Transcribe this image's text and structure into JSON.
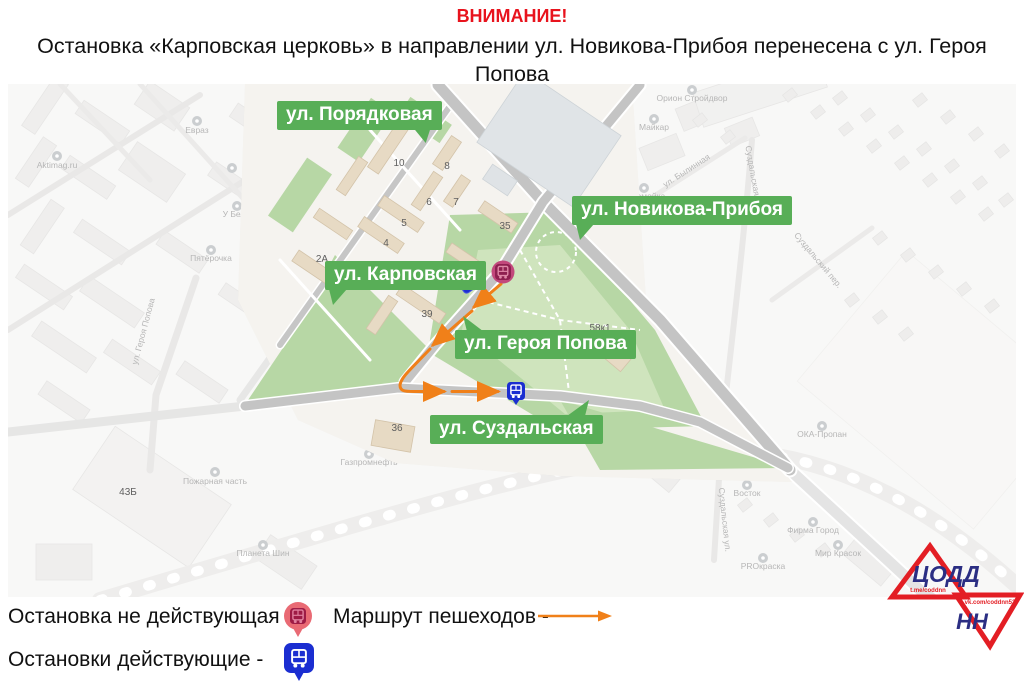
{
  "header": {
    "attention": "ВНИМАНИЕ!",
    "line1": "Остановка «Карповская церковь» в направлении ул. Новикова-Прибоя перенесена с ул. Героя Попова",
    "line2": "на ул. Суздальскую в связи с изменением движения маршрутов общественного транспорта."
  },
  "map": {
    "street_badges": [
      {
        "label": "ул. Порядковая"
      },
      {
        "label": "ул. Новикова-Прибоя"
      },
      {
        "label": "ул. Карповская"
      },
      {
        "label": "ул. Героя Попова"
      },
      {
        "label": "ул. Суздальская"
      }
    ],
    "building_numbers": [
      "10",
      "8",
      "6",
      "7",
      "5",
      "4",
      "2А",
      "35",
      "37",
      "39",
      "36",
      "58к1",
      "43Б"
    ],
    "minor_labels": [
      {
        "text": "Карповская ул."
      },
      {
        "text": "Aktimag.ru"
      },
      {
        "text": "Евраз"
      },
      {
        "text": "У Белы"
      },
      {
        "text": "Пятёрочка"
      },
      {
        "text": "ул. Героя Попова"
      },
      {
        "text": "Пожарная часть"
      },
      {
        "text": "Газпромнефть"
      },
      {
        "text": "Планета Шин"
      },
      {
        "text": "Орион Стройдвор"
      },
      {
        "text": "Майкар"
      },
      {
        "text": "Автомойка"
      },
      {
        "text": "ул. Былинная"
      },
      {
        "text": "Суздальская ул."
      },
      {
        "text": "Суздальский пер."
      },
      {
        "text": "Суздальская ул."
      },
      {
        "text": "ОКА-Пропан"
      },
      {
        "text": "Стройбери"
      },
      {
        "text": "Восток"
      },
      {
        "text": "Фирма Город"
      },
      {
        "text": "Мир Красок"
      },
      {
        "text": "PROкраска"
      }
    ]
  },
  "legend": {
    "inactive_stop_label": "Остановка не действующая -",
    "pedestrian_route_label": "Маршрут пешеходов -",
    "active_stops_label": "Остановки действующие -"
  },
  "logo": {
    "line1": "ЦОДД",
    "line2": "НН",
    "tg": "t.me/coddnn",
    "vk": "vk.com/coddnn52"
  },
  "colors": {
    "badge_green": "#58ae57",
    "route_orange": "#f08019",
    "active_stop_blue": "#1b2ed1",
    "inactive_stop_red": "#c2487c",
    "attention_red": "#e8131d",
    "logo_red": "#e31e24",
    "logo_blue": "#2b2e83"
  }
}
